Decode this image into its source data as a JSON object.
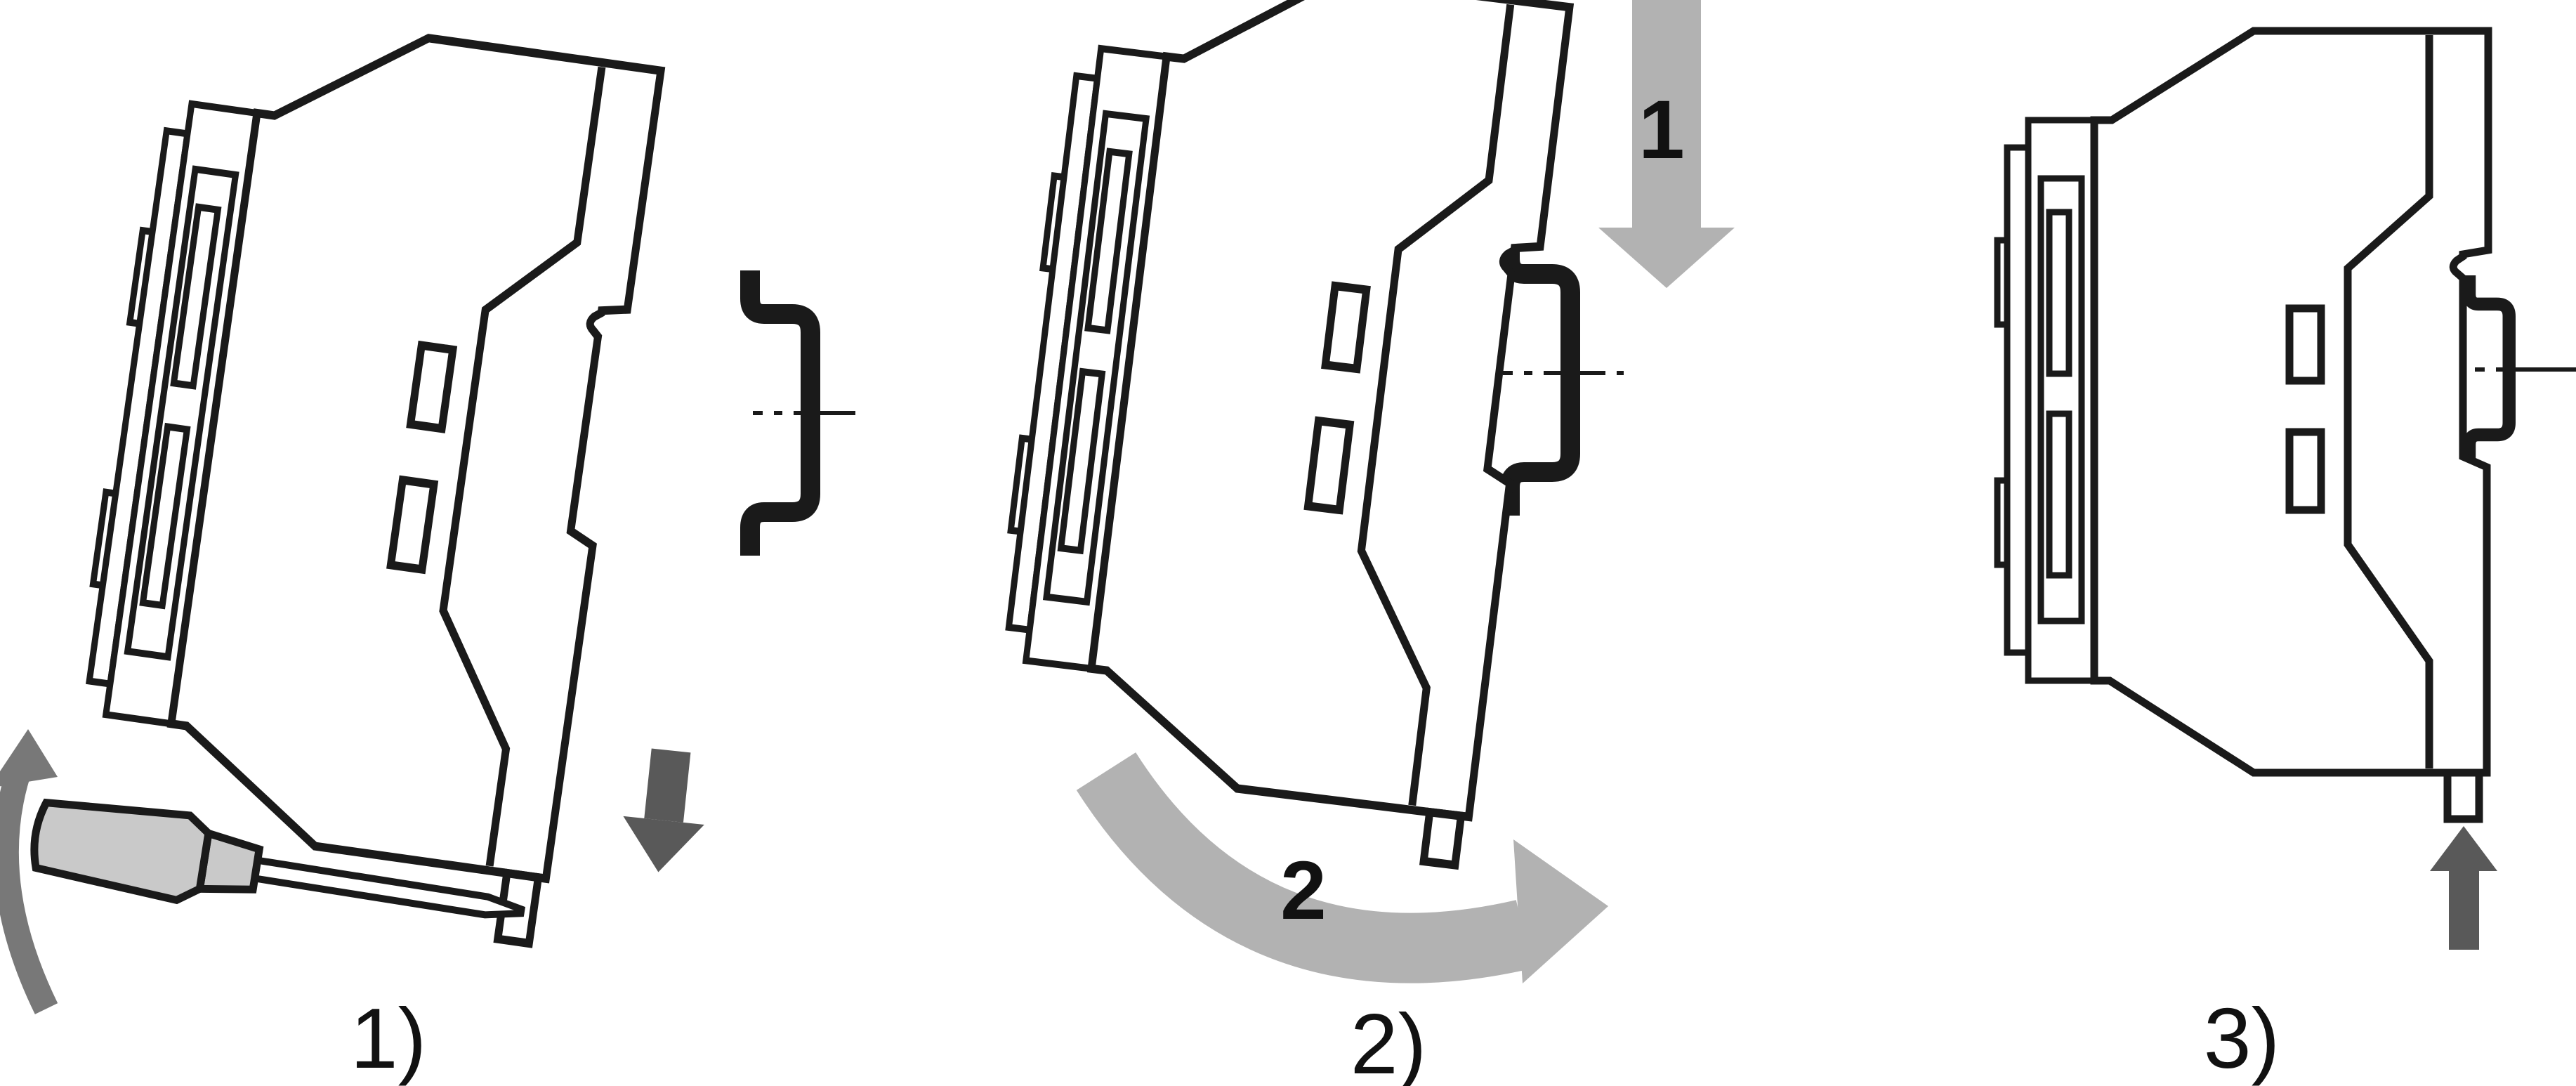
{
  "diagram": {
    "kind": "din-rail-mounting-instructions",
    "steps": [
      {
        "label": "1)"
      },
      {
        "label": "2)",
        "motion_1": "1",
        "motion_2": "2"
      },
      {
        "label": "3)"
      }
    ],
    "colors": {
      "background": "#ffffff",
      "outline": "#1a1a1a",
      "arrow_light_gray": "#b2b2b2",
      "arrow_dark_gray": "#595959",
      "arrow_mid_gray": "#787878",
      "screwdriver_handle": "#c9c9c9",
      "screwdriver_shaft": "#ffffff",
      "label_color": "#111111"
    },
    "icons": [
      "device-module-icon",
      "din-rail-icon",
      "screwdriver-icon",
      "rotate-up-arc-arrow-icon",
      "latch-down-arrow-icon",
      "big-down-arrow-icon",
      "swing-arc-arrow-icon",
      "push-up-arrow-icon",
      "rail-centerline-icon"
    ]
  }
}
